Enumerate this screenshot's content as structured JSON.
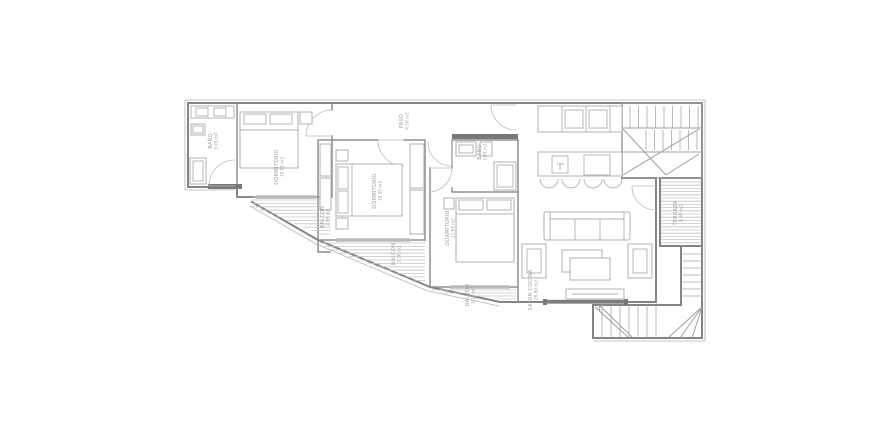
{
  "drawing": {
    "type": "apartment-floor-plan",
    "units": "m2"
  },
  "rooms": {
    "bath1": {
      "label": "BAÑO",
      "area": "3.70 m2"
    },
    "bedroom1": {
      "label": "DORMITORIO",
      "area": "10.95 m2"
    },
    "bedroom2": {
      "label": "DORMITORIO",
      "area": "10.35 m2"
    },
    "bedroom3": {
      "label": "DORMITORIO",
      "area": "11.65 m2"
    },
    "paso": {
      "label": "PASO",
      "area": "4.10 m2"
    },
    "bath2": {
      "label": "BAÑO",
      "area": "3.45 m2"
    },
    "salon": {
      "label": "SALON COCINA",
      "area": "26.80 m2"
    },
    "balcony1": {
      "label": "BALCON",
      "area": "4.95 m2"
    },
    "balcony2": {
      "label": "BALCON",
      "area": "5.20 m2"
    },
    "balcony3": {
      "label": "BALCON",
      "area": "3.15 m2"
    },
    "terrace": {
      "label": "TERRAZA",
      "area": "8.40 m2"
    }
  },
  "colors": {
    "background": "#ffffff",
    "wall": "#848484",
    "furniture": "#b0b0b0",
    "hatch": "#c6c6c6",
    "accent_dark": "#787878",
    "text": "#9d9d9d"
  }
}
